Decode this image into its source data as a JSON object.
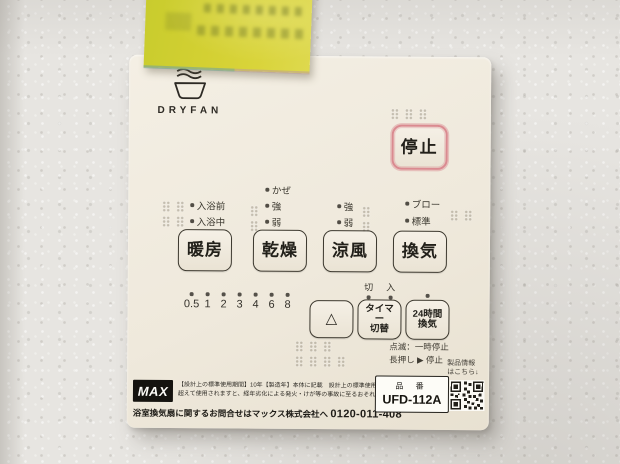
{
  "panel": {
    "brand": "DRYFAN",
    "stop": {
      "label": "停止"
    },
    "modes": [
      {
        "label": "暖房",
        "options": [
          "入浴前",
          "入浴中"
        ]
      },
      {
        "label": "乾燥",
        "options": [
          "かぜ",
          "強",
          "弱"
        ]
      },
      {
        "label": "涼風",
        "options": [
          "強",
          "弱"
        ]
      },
      {
        "label": "換気",
        "options": [
          "ブロー",
          "標準"
        ]
      }
    ],
    "timer_numbers": [
      "0.5",
      "1",
      "2",
      "3",
      "4",
      "6",
      "8"
    ],
    "switch_labels": {
      "off": "切",
      "on": "入"
    },
    "arrow_button": "△",
    "timer_button": {
      "line1": "タイマー",
      "line2": "切替"
    },
    "vent24_button": {
      "line1": "24時間",
      "line2": "換気"
    },
    "hint_blink": "点滅：一時停止",
    "hint_hold": "長押し ▶ 停止",
    "footer": {
      "logo": "MAX",
      "notice1": "【設計上の標準使用期間】10年【製造年】本体に記載　設計上の標準使用期間を",
      "notice2": "超えて使用されますと、経年劣化による発火・けが等の事故に至るおそれがあります。",
      "contact": "浴室換気扇に関するお問合せはマックス株式会社へ ",
      "phone": "0120-011-408",
      "product_info1": "製品情報",
      "product_info2": "はこちら↓",
      "part_label": "品 番",
      "part_number": "UFD-112A"
    }
  },
  "colors": {
    "panel": "#efe9dc",
    "wall": "#e7e5e1",
    "sticky_note": "#d3d032",
    "stop_accent": "#da8a90"
  }
}
